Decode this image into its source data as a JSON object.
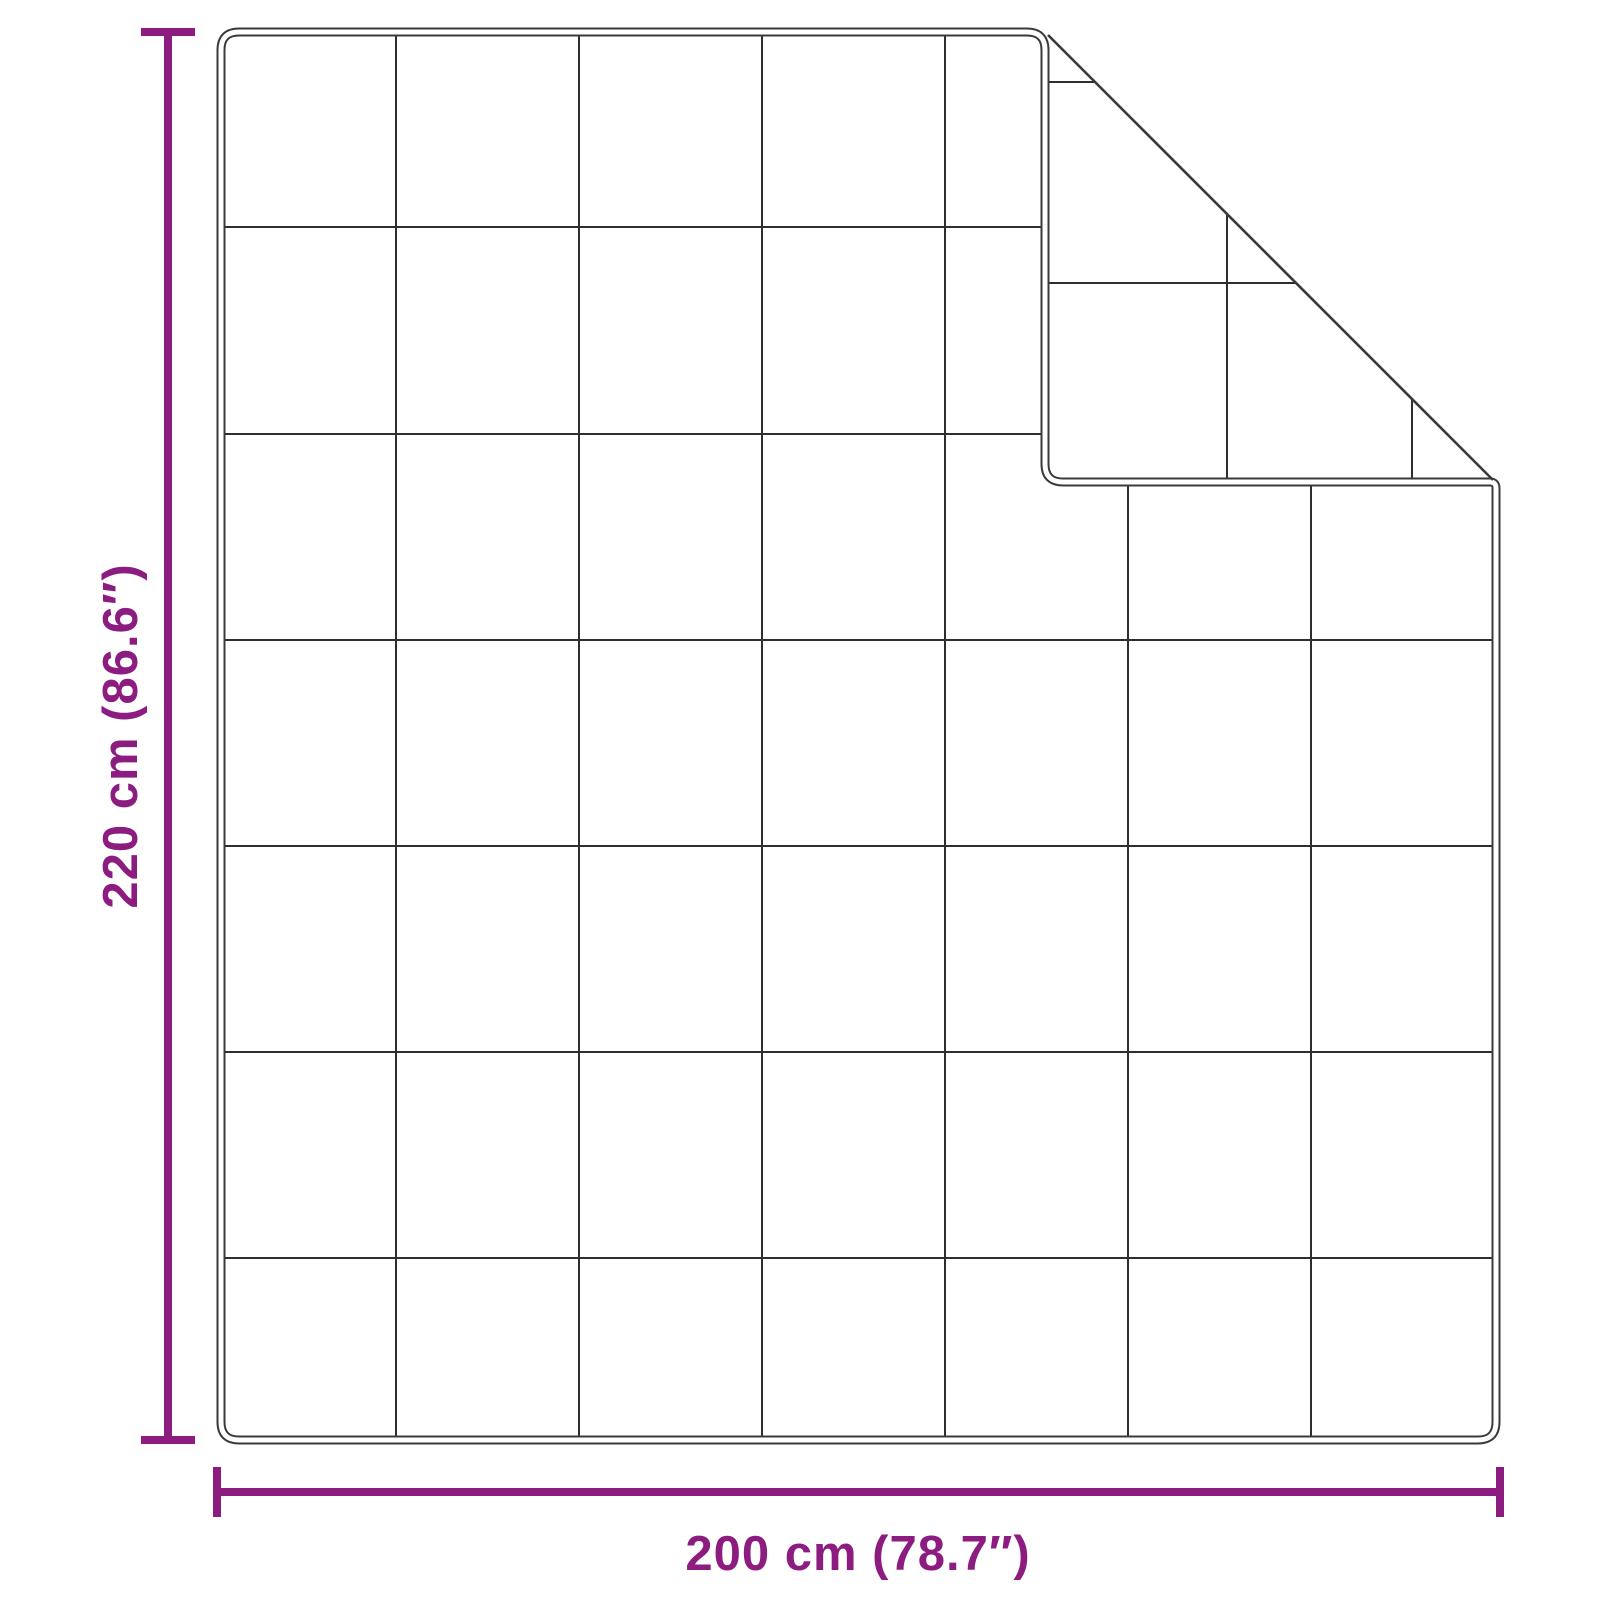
{
  "diagram": {
    "kind": "product-dimension-diagram",
    "background_color": "#ffffff",
    "outline_color": "#3a3a3a",
    "accent_color": "#8C1C80",
    "blanket": {
      "grid_columns": 7,
      "grid_rows": 7,
      "folded_corner": "top-right"
    },
    "dimensions": {
      "height": {
        "label": "220 cm (86.6″)",
        "cm": "220",
        "inches": "86.6"
      },
      "width": {
        "label": "200 cm (78.7″)",
        "cm": "200",
        "inches": "78.7"
      }
    }
  }
}
